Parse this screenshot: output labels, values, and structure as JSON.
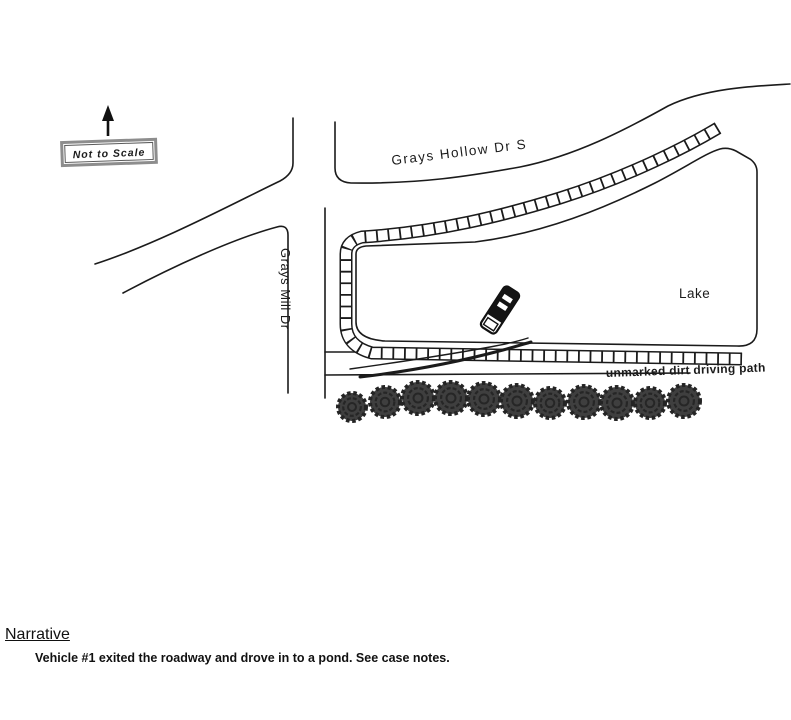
{
  "diagram": {
    "north_label": "N",
    "scale_box_label": "Not to Scale",
    "roads": {
      "hollow_label": "Grays Hollow Dr S",
      "mill_label": "Grays Mill Dr"
    },
    "lake_label": "Lake",
    "dirt_path_label": "unmarked dirt driving path"
  },
  "narrative": {
    "heading": "Narrative",
    "body": "Vehicle #1 exited the roadway and drove in to a pond. See case notes."
  },
  "colors": {
    "ink": "#1b1b1b",
    "tree_fill": "#3f3f3f",
    "tree_ring": "#242424",
    "scale_box_border": "#8d8d8d"
  }
}
